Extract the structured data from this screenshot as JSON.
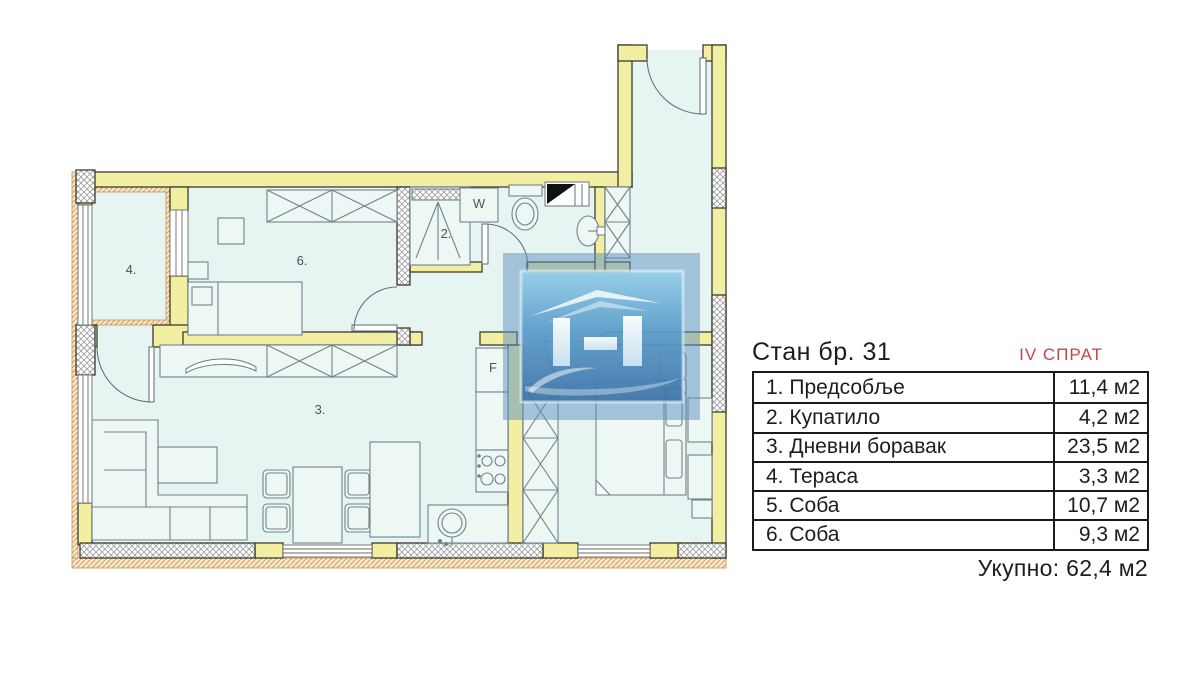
{
  "panel": {
    "title": "Стан бр. 31",
    "floor": "IV СПРАТ",
    "rows": [
      {
        "name": "1. Предсобље",
        "area": "11,4 м2"
      },
      {
        "name": "2. Купатило",
        "area": "4,2 м2"
      },
      {
        "name": "3. Дневни боравак",
        "area": "23,5 м2"
      },
      {
        "name": "4. Тераса",
        "area": "3,3 м2"
      },
      {
        "name": "5. Соба",
        "area": "10,7 м2"
      },
      {
        "name": "6. Соба",
        "area": "9,3 м2"
      }
    ],
    "total": "Укупно: 62,4 м2"
  },
  "plan": {
    "labels": {
      "bathroom": "2.",
      "living_room": "3.",
      "terrace": "4.",
      "room6": "6.",
      "washer": "W",
      "fridge": "F"
    }
  },
  "colors": {
    "wall_yellow": "#F2EFA3",
    "floor_cyan": "#E7F5F2",
    "accent_red": "#C4464A",
    "watermark_blue": "#4E87BC",
    "line_dark": "#3C3C30",
    "insulation_tan": "#F6E9CB"
  }
}
